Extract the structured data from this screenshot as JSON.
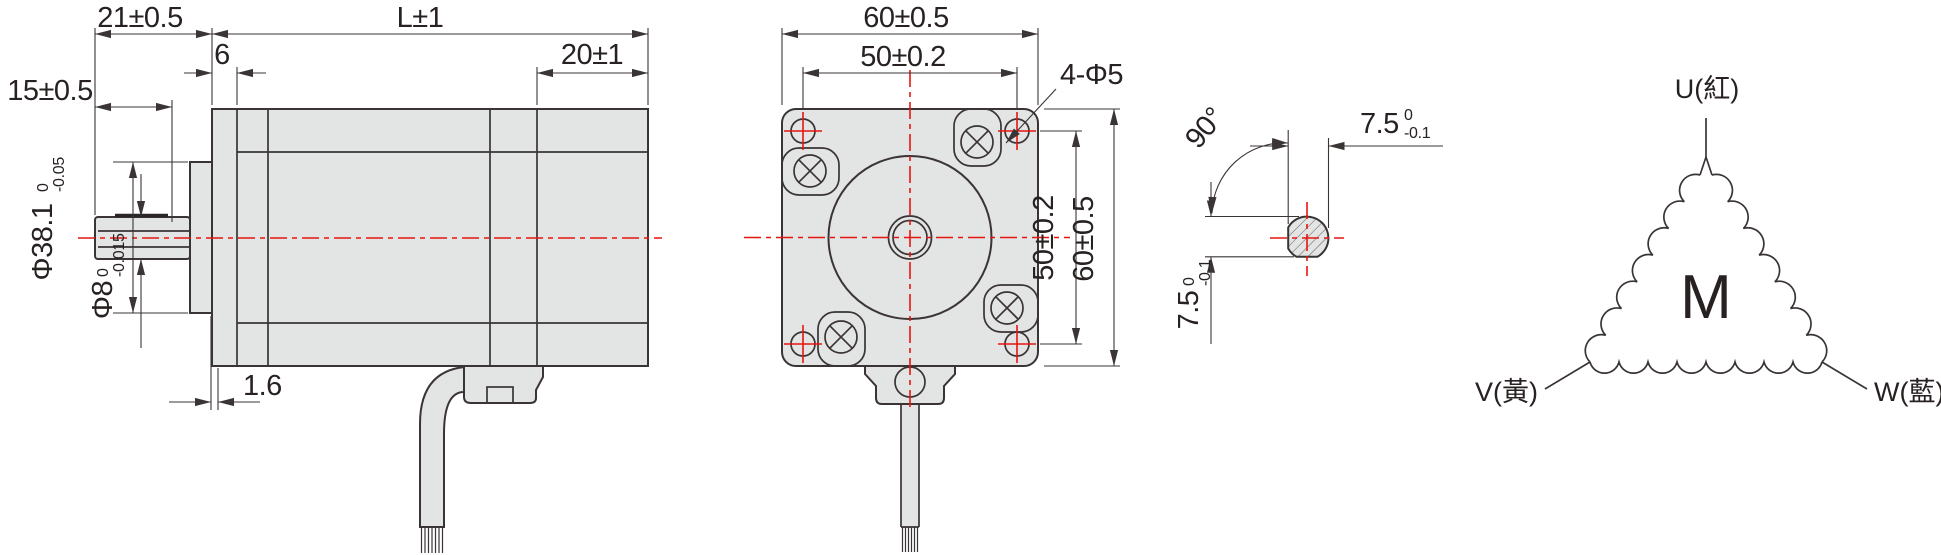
{
  "drawing": {
    "side_view": {
      "dim_shaft_length": "15±0.5",
      "dim_front_length": "21±0.5",
      "dim_body_length": "L±1",
      "dim_pilot_width": "6",
      "dim_rear_cap": "20±1",
      "dim_flange_lip": "1.6",
      "pilot_dia": {
        "nominal": "Φ38.1",
        "tol_upper": "0",
        "tol_lower": "-0.05"
      },
      "shaft_dia": {
        "nominal": "Φ8",
        "tol_upper": "0",
        "tol_lower": "-0.015"
      }
    },
    "front_view": {
      "dim_width": "60±0.5",
      "dim_hole_pitch_x": "50±0.2",
      "dim_holes": "4-Φ5",
      "dim_hole_pitch_y": "50±0.2",
      "dim_height": "60±0.5"
    },
    "shaft_section": {
      "dim_angle": "90°",
      "dim_across_flat_h": {
        "nominal": "7.5",
        "tol_upper": "0",
        "tol_lower": "-0.1"
      },
      "dim_across_flat_v": {
        "nominal": "7.5",
        "tol_upper": "0",
        "tol_lower": "-0.1"
      }
    },
    "wiring": {
      "motor_symbol": "M",
      "terminal_u": "U(紅)",
      "terminal_v": "V(黃)",
      "terminal_w": "W(藍)"
    },
    "colors": {
      "line": "#3a3434",
      "fill": "#e3e4e4",
      "centerline_red": "#e8150f"
    }
  }
}
